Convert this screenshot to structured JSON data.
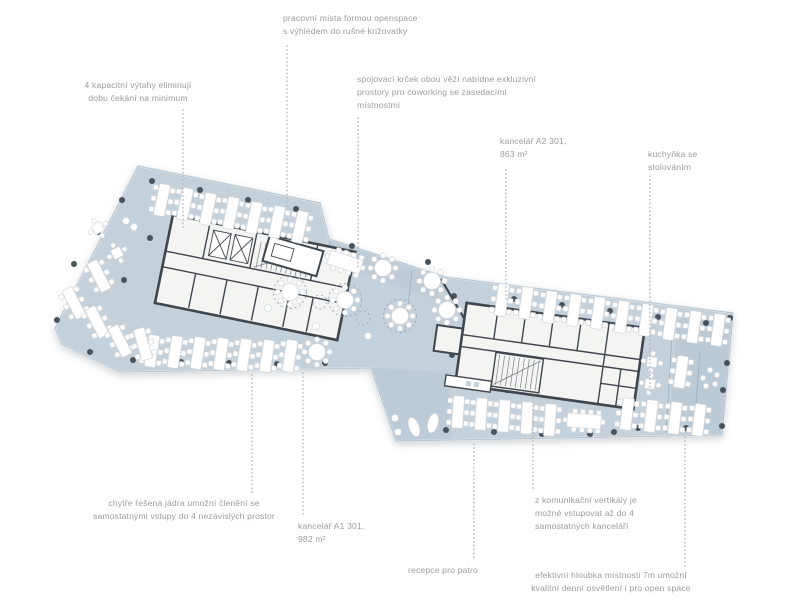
{
  "figure": {
    "type": "architectural-floor-plan",
    "floor": "openspace office level"
  },
  "colors": {
    "floor": "#c4d1db",
    "floor_zone": "#8fa9bd",
    "wall": "#3f464d",
    "column": "#49525a",
    "core_fill": "#f4f4f3",
    "furniture": "#ffffff",
    "furniture_stroke": "#d3d9de",
    "leader": "#b5b5b5",
    "ann_text": "#9c9c9c"
  },
  "annotations": [
    {
      "id": "openspace",
      "lines": [
        "pracovní místa formou openspace",
        "s výhledem do rušné križovatky"
      ],
      "leader": {
        "x": 287,
        "y1": 46,
        "y2": 206
      }
    },
    {
      "id": "vytahy",
      "lines": [
        "4 kapacitní výtahy eliminují",
        "dobu čekání na minimum"
      ],
      "leader": {
        "x": 183,
        "y1": 110,
        "y2": 230
      }
    },
    {
      "id": "krcek",
      "lines": [
        "spojovací krček obou věží nabídne exkluzivní",
        "prostory pro coworking se zasedacími",
        "místnostmi"
      ],
      "leader": {
        "x": 358,
        "y1": 118,
        "y2": 268
      }
    },
    {
      "id": "kancelar-a2",
      "lines": [
        "kancelář A2 301,",
        "863 m²"
      ],
      "leader": {
        "x": 506,
        "y1": 170,
        "y2": 300
      }
    },
    {
      "id": "kuchynka",
      "lines": [
        "kuchyňka se",
        "stolováním"
      ],
      "leader": {
        "x": 650,
        "y1": 176,
        "y2": 393
      }
    },
    {
      "id": "jadra",
      "lines": [
        "chytře řešená jádra umožní členění se",
        "samostatnými vstupy do 4 nezávislých prostor"
      ],
      "leader": {
        "x": 252,
        "y1": 375,
        "y2": 494
      }
    },
    {
      "id": "kancelar-a1",
      "lines": [
        "kancelář A1 301,",
        "982 m²"
      ],
      "leader": {
        "x": 303,
        "y1": 373,
        "y2": 517
      }
    },
    {
      "id": "vertikala",
      "lines": [
        "z komunikační vertikály je",
        "možné vstupovat až do 4",
        "samostatných kanceláří"
      ],
      "leader": {
        "x": 533,
        "y1": 398,
        "y2": 491
      }
    },
    {
      "id": "recepce",
      "lines": [
        "recepce pro patro"
      ],
      "leader": {
        "x": 474,
        "y1": 444,
        "y2": 561
      }
    },
    {
      "id": "hloubka",
      "lines": [
        "efektivní hloubka místnosti 7m umožní",
        "kvalitní denní osvětlení i pro open space"
      ],
      "leader": {
        "x": 685,
        "y1": 437,
        "y2": 566
      }
    }
  ]
}
